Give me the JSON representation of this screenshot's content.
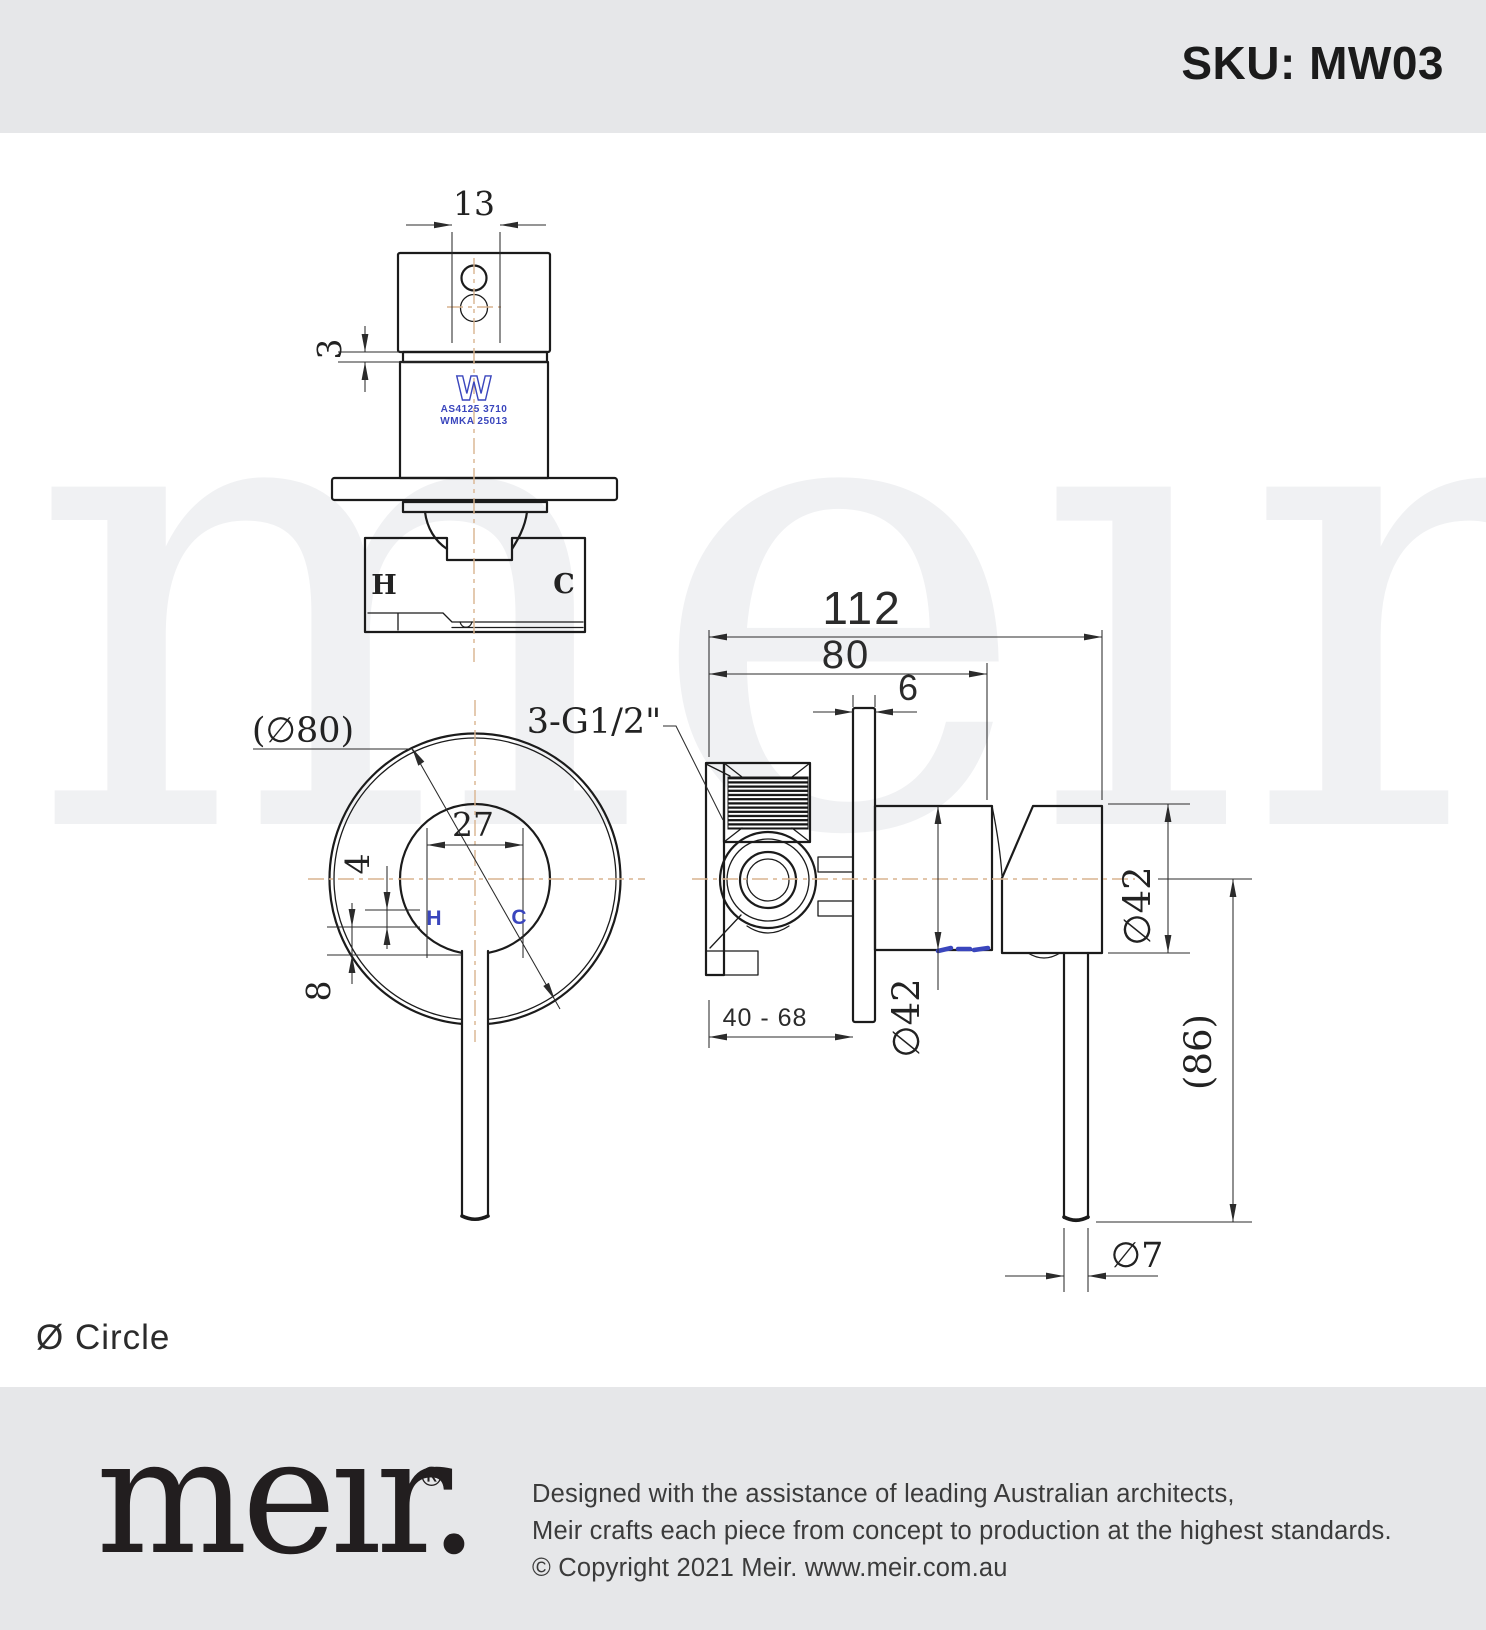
{
  "header": {
    "sku": "SKU: MW03"
  },
  "watermark": {
    "wordmark": "meır."
  },
  "views": {
    "top": {
      "dim_width_13": "13",
      "dim_height_3": "3",
      "hot": "H",
      "cold": "C",
      "cert_logo": "W",
      "cert_line1": "AS4125 3710",
      "cert_line2": "WMKA 25013"
    },
    "front": {
      "dim_plate_dia": "(∅80)",
      "dim_27": "27",
      "dim_4": "4",
      "dim_8": "8",
      "hot": "H",
      "cold": "C"
    },
    "side": {
      "dim_112": "112",
      "dim_80": "80",
      "dim_6": "6",
      "thread_spec": "3-G1/2\"",
      "dim_range": "40 - 68",
      "dim_body_dia": "∅42",
      "dim_handle_dia": "∅42",
      "dim_handle_len": "(86)",
      "dim_rod_dia": "∅7"
    }
  },
  "caption": {
    "shape_label": "Ø Circle"
  },
  "footer": {
    "logo": "meır.",
    "registered": "®",
    "line1": "Designed with the assistance of leading Australian architects,",
    "line2": "Meir crafts each piece from concept to production at the highest standards.",
    "line3": "© Copyright 2021 Meir. www.meir.com.au"
  },
  "colors": {
    "band_bg": "#e6e7e9",
    "line": "#1b1b1b",
    "centerline": "#d9b48f",
    "accent_blue": "#3a46bd"
  }
}
